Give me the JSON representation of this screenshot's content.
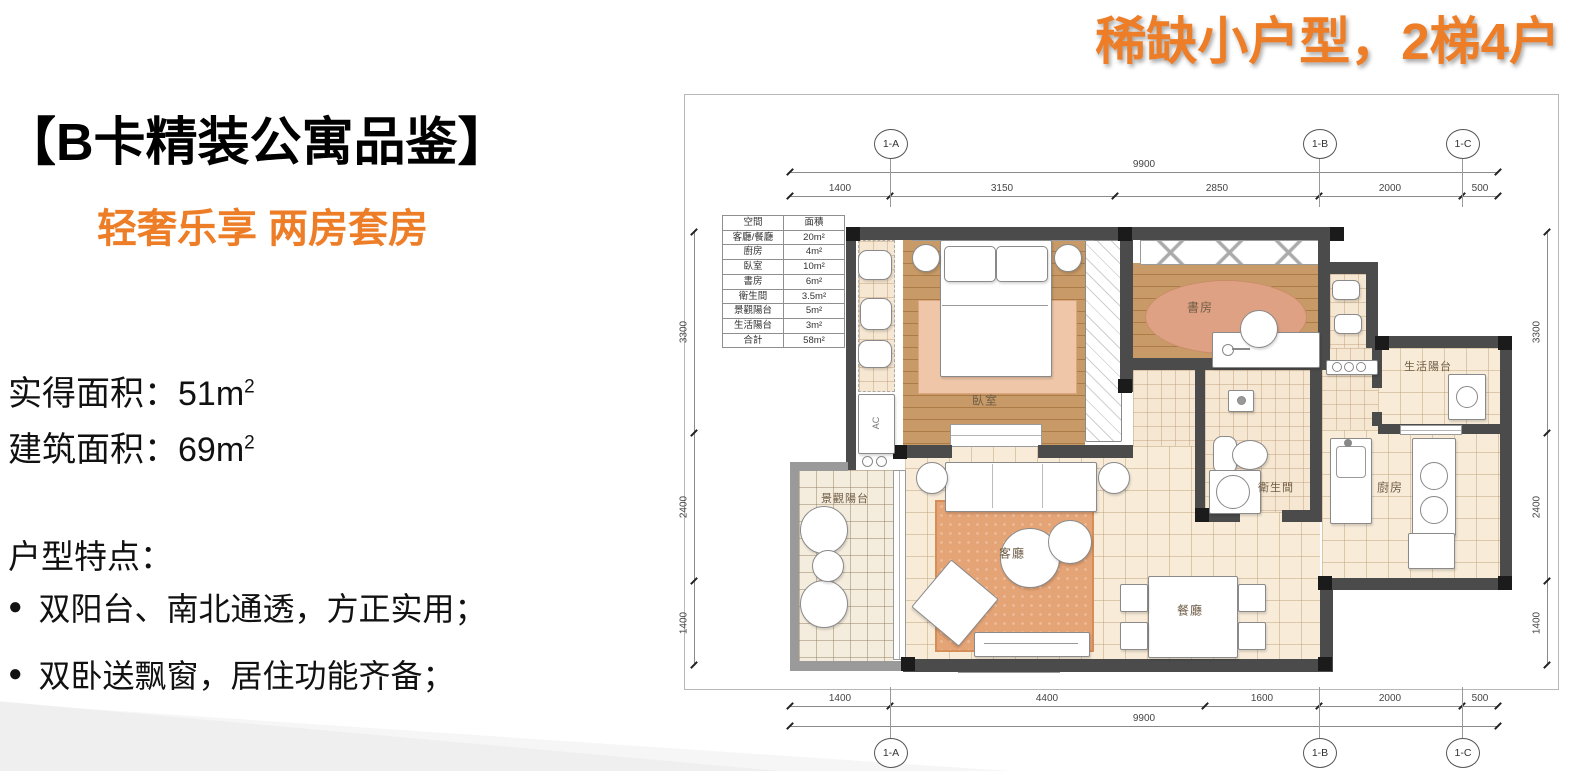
{
  "slide": {
    "top_right_title": "稀缺小户型，2梯4户",
    "left": {
      "title": "【B卡精装公寓品鉴】",
      "subtitle": "轻奢乐享 两房套房",
      "areas": [
        {
          "label": "实得面积：",
          "value": "51m",
          "sup": "2"
        },
        {
          "label": "建筑面积：",
          "value": "69m",
          "sup": "2"
        }
      ],
      "features_title": "户型特点：",
      "bullet_glyph": "●",
      "features": [
        "双阳台、南北通透，方正实用；",
        "双卧送飘窗，居住功能齐备；"
      ]
    },
    "colors": {
      "accent_orange": "#ed7d26",
      "wall_gray": "#4b4b4b",
      "wood_floor": "#c79a67",
      "tile_floor": "#f8ecd9",
      "rug": "#e5a476"
    }
  },
  "floorplan": {
    "area_table": {
      "headers": [
        "空間",
        "面積"
      ],
      "rows": [
        [
          "客廳/餐廳",
          "20m²"
        ],
        [
          "廚房",
          "4m²"
        ],
        [
          "臥室",
          "10m²"
        ],
        [
          "書房",
          "6m²"
        ],
        [
          "衛生間",
          "3.5m²"
        ],
        [
          "景觀陽台",
          "5m²"
        ],
        [
          "生活陽台",
          "3m²"
        ],
        [
          "合計",
          "58m²"
        ]
      ]
    },
    "grid_bubbles": [
      "1-A",
      "1-B",
      "1-C"
    ],
    "dims_top": {
      "overall": "9900",
      "segments": [
        "1400",
        "3150",
        "2850",
        "2000",
        "500"
      ]
    },
    "dims_bottom": {
      "overall": "9900",
      "segments": [
        "1400",
        "4400",
        "1600",
        "2000",
        "500"
      ]
    },
    "dims_left": [
      "3300",
      "2400",
      "1400"
    ],
    "dims_right": [
      "3300",
      "2400",
      "1400"
    ],
    "room_labels": {
      "bedroom": "臥室",
      "study": "書房",
      "living": "客廳",
      "dining": "餐廳",
      "bathroom": "衛生間",
      "kitchen": "廚房",
      "view_balcony": "景觀陽台",
      "utility_balcony": "生活陽台",
      "ac": "AC"
    }
  }
}
